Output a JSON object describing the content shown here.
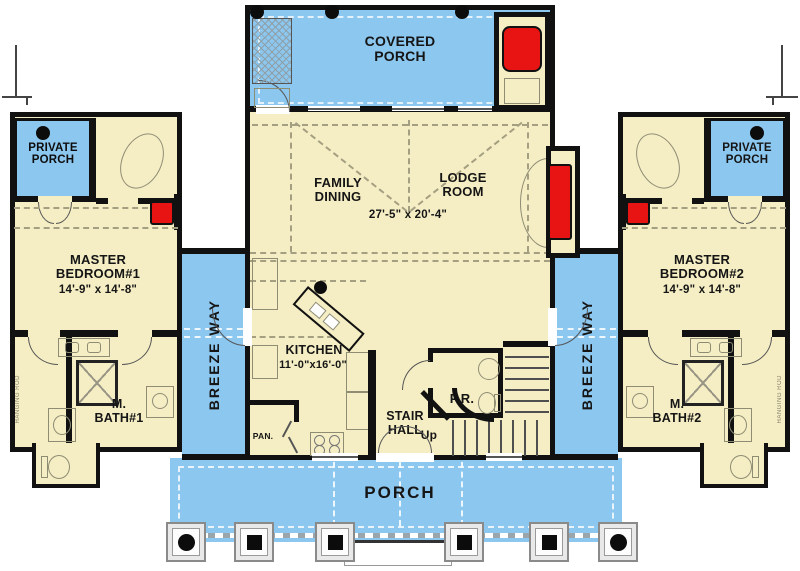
{
  "plan": {
    "labels": {
      "covered_porch": "COVERED PORCH",
      "family_dining": "FAMILY DINING",
      "lodge_room": "LODGE ROOM",
      "great_room_dim": "27'-5\" x 20'-4\"",
      "master_bedroom_1": "MASTER BEDROOM#1",
      "master_bedroom_1_dim": "14'-9\" x 14'-8\"",
      "master_bedroom_2": "MASTER BEDROOM#2",
      "master_bedroom_2_dim": "14'-9\" x 14'-8\"",
      "private_porch": "PRIVATE PORCH",
      "breezeway": "BREEZE WAY",
      "kitchen": "KITCHEN",
      "kitchen_dim": "11'-0\"x16'-0\"",
      "stair_hall": "STAIR HALL",
      "up": "Up",
      "powder_room": "P.R.",
      "pantry": "PAN.",
      "master_bath_1": "M. BATH#1",
      "master_bath_2": "M. BATH#2",
      "porch": "PORCH",
      "hanging_rod": "HANGING ROD"
    },
    "colors": {
      "porch-blue": "#8cc7ef",
      "floor-cream": "#f5eec4",
      "wall-black": "#111111",
      "fireplace-red": "#e81414",
      "fixture-gray": "#8f8c74"
    }
  }
}
